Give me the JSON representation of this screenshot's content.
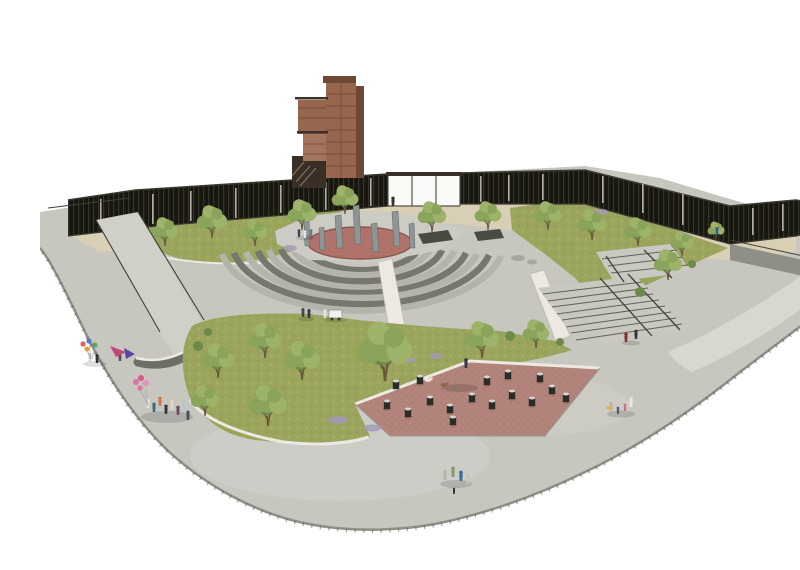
{
  "meta": {
    "title": "Memorial plaza park – aerial architectural rendering",
    "canvas": {
      "width": 800,
      "height": 538
    }
  },
  "scene": {
    "description": "Aerial perspective rendering of a curved public memorial plaza: corten-steel observation tower and dark slatted perimeter fence with a glazed pavilion at the back, seven grey memorial steles on a red gravel oval ringed by curved amphitheater steps, lawns with scattered trees, a triangular red-paved dog run with dark bollards, ramps and stairs with railings, and small groups of visitors, balloons, dogs and a cyclist on the grey concrete esplanade.",
    "elements": [
      {
        "name": "observation-tower",
        "label": "Corten steel observation tower"
      },
      {
        "name": "perimeter-fence",
        "label": "Dark vertical-slat perimeter fence"
      },
      {
        "name": "glass-pavilion",
        "label": "Glazed pavilion wall section"
      },
      {
        "name": "memorial-steles",
        "label": "Grey memorial steles",
        "count": 7
      },
      {
        "name": "gravel-oval",
        "label": "Red gravel oval under steles"
      },
      {
        "name": "amphitheater-steps",
        "label": "Curved amphitheater steps",
        "count": 8
      },
      {
        "name": "lawns",
        "label": "Planted lawn areas",
        "count": 3
      },
      {
        "name": "trees",
        "label": "Trees",
        "count": 21
      },
      {
        "name": "dog-park",
        "label": "Triangular red-paved dog run"
      },
      {
        "name": "bollards",
        "label": "Dark cylindrical bollard seats",
        "count": 16
      },
      {
        "name": "stairs-right",
        "label": "Twin stair flights with railings"
      },
      {
        "name": "ramps-left",
        "label": "Switchback access ramps"
      },
      {
        "name": "vendor-cart",
        "label": "White vendor cart"
      },
      {
        "name": "dogs",
        "label": "Dogs in dog run",
        "count": 3
      },
      {
        "name": "balloons",
        "label": "Balloon bunches",
        "count": 2
      },
      {
        "name": "cyclist",
        "label": "Cyclist by the fence"
      },
      {
        "name": "people-groups",
        "label": "Groups of visitors",
        "count": 8
      }
    ]
  },
  "colors": {
    "background": "#ffffff",
    "plaza": "#c7c7c0",
    "plazaLight": "#dadad4",
    "plazaEdge": "#8f8f87",
    "plazaTick": "#55554e",
    "terrace": "#d8cfb4",
    "lawn": "#9aa45c",
    "lawnLight": "#b7bf6e",
    "lawnDark": "#7d8f49",
    "foliage": "#8aa45c",
    "foliageLight": "#9db36a",
    "foliageDark": "#6d8a48",
    "trunk": "#6b563f",
    "fence": "#17160f",
    "fenceSlit": "#d8d4c6",
    "fenceRail": "#3b3a30",
    "glass": "#fafaf8",
    "glassFrame": "#55544c",
    "towerCorten": "#96664e",
    "towerCortenDark": "#6e4834",
    "towerCortenLight": "#a3755c",
    "towerSteel": "#3a2f26",
    "step": "#b4b4ac",
    "stepDark": "#77776f",
    "stairTread": "#c9c9c1",
    "stairLine": "#62625a",
    "railing": "#3f3f39",
    "monumentPad": "#ccccc4",
    "monumentGravel": "#b0736a",
    "monumentGravelEdge": "#8a584e",
    "stele": "#8f9494",
    "steleDark": "#63686a",
    "dogPark": "#b2847b",
    "dogParkDot": "#8f5f55",
    "bollard": "#2b2b28",
    "bollardTop": "#d5d5d0",
    "wallWhite": "#ebe9e1",
    "wallGray": "#6e6e66",
    "rampSurface": "#d0d0c9",
    "rock": "#a8a8a0",
    "lavender": "#a39ab5",
    "shadow": "#000000",
    "personDark": "#34343c",
    "personNavy": "#3c4452",
    "personWhite": "#e8e6e0",
    "personTeal": "#3a6a74",
    "personRed": "#8a2f2a",
    "personPink": "#d06a7a",
    "personTan": "#c9b292",
    "personBlue": "#2a5aa0",
    "balloonPink": "#e070a8",
    "balloonBlue": "#5878d0",
    "balloonRed": "#e06060",
    "balloonGreen": "#60a860",
    "balloonYellow": "#e0a030",
    "dogBrown": "#8a6a4a",
    "dogWhite": "#e8e6e0",
    "dogGray": "#7a7a72"
  }
}
